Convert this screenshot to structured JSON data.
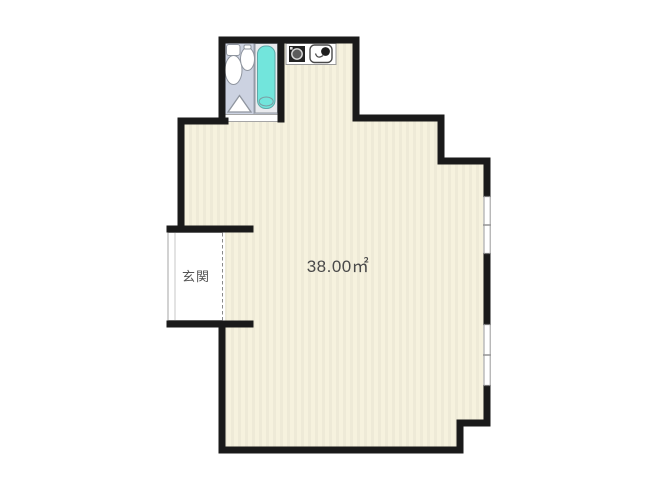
{
  "plan": {
    "type": "floor-plan",
    "room": {
      "area_label": "38.00㎡"
    },
    "entrance": {
      "label": "玄関"
    },
    "fixtures": [
      "toilet",
      "bathroom-sink",
      "bathtub",
      "washing-machine",
      "stove-burner"
    ],
    "windows": [
      {
        "side": "right",
        "position": "upper",
        "panes": 2
      },
      {
        "side": "right",
        "position": "lower",
        "panes": 2
      }
    ],
    "colors": {
      "wall": "#1a1a1a",
      "floor": "#f6f2de",
      "floor_stripe": "#ece7cf",
      "bathroom_floor": "#ccd2e1",
      "bathtub": "#72e5dc",
      "fixture_outline": "#8f959f",
      "thin_line": "#8a8a8a",
      "background": "#ffffff"
    }
  }
}
